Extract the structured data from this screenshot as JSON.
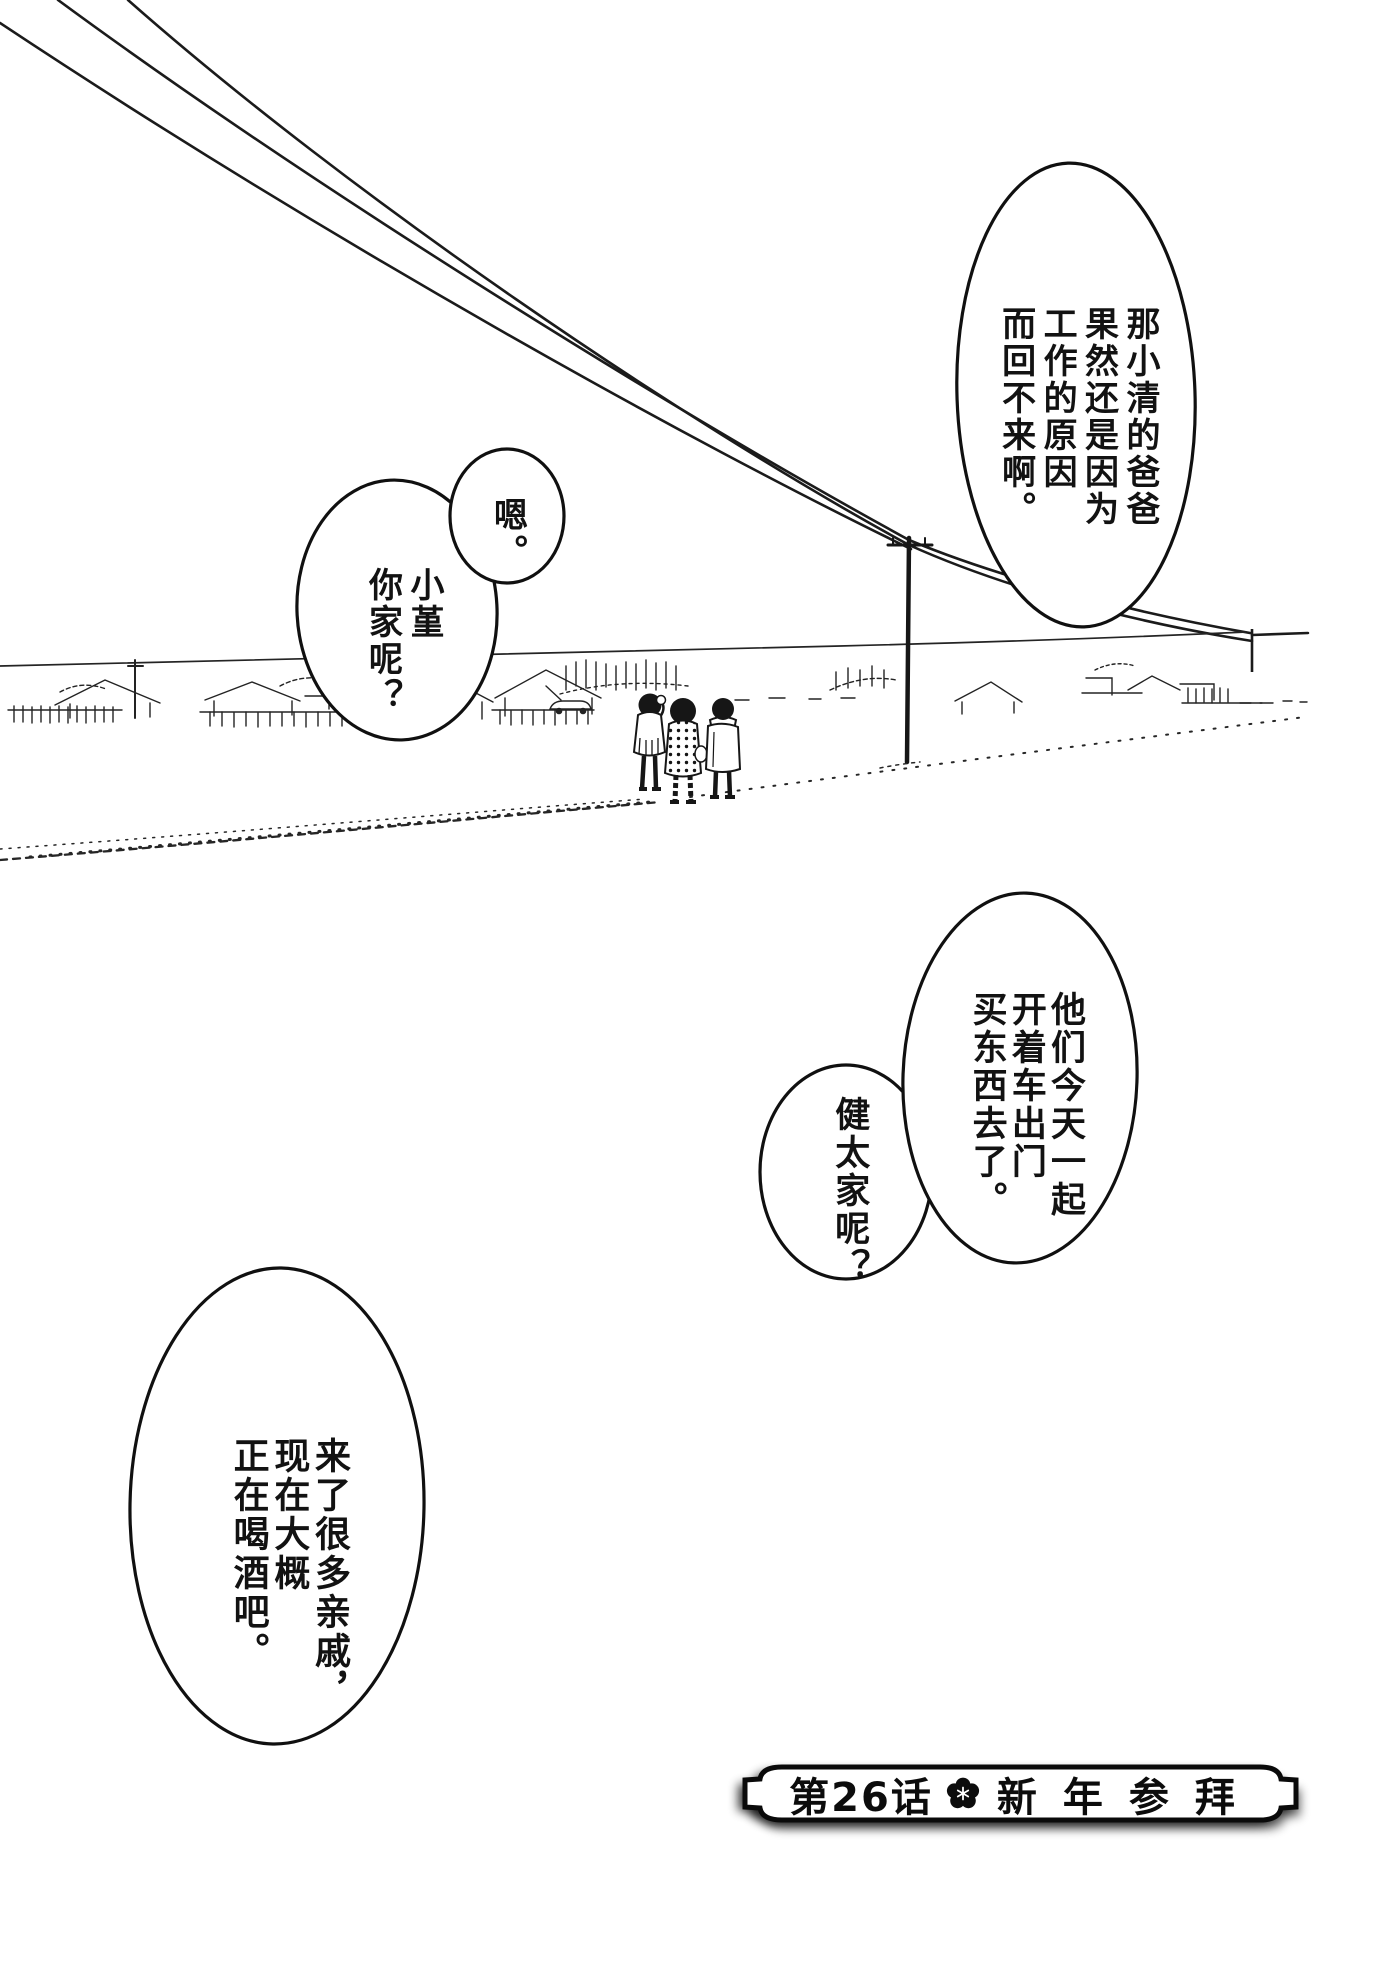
{
  "bubbles": {
    "father_reason": {
      "lines": [
        "那小清的爸爸",
        "果然还是因为",
        "工作的原因",
        "而回不来啊。"
      ]
    },
    "acknowledge": {
      "lines": [
        "嗯。"
      ]
    },
    "sumire_question": {
      "lines": [
        "小堇",
        "你家呢？"
      ]
    },
    "kenta_answer": {
      "lines": [
        "他们今天一起",
        "开着车出门",
        "买东西去了。"
      ]
    },
    "kenta_question": {
      "lines": [
        "健太家呢？"
      ]
    },
    "relatives_answer": {
      "lines": [
        "来了很多亲戚，",
        "现在大概",
        "正在喝酒吧。"
      ]
    }
  },
  "banner": {
    "chapter": "第26话",
    "title": "新年参拜",
    "flower_icon": "plum-blossom-icon"
  },
  "scene_icons": {
    "power_lines": "power-lines",
    "telephone_pole": "telephone-pole",
    "village": "village-skyline",
    "children": "three-children-walking"
  },
  "colors": {
    "ink": "#111111",
    "paper": "#ffffff"
  }
}
